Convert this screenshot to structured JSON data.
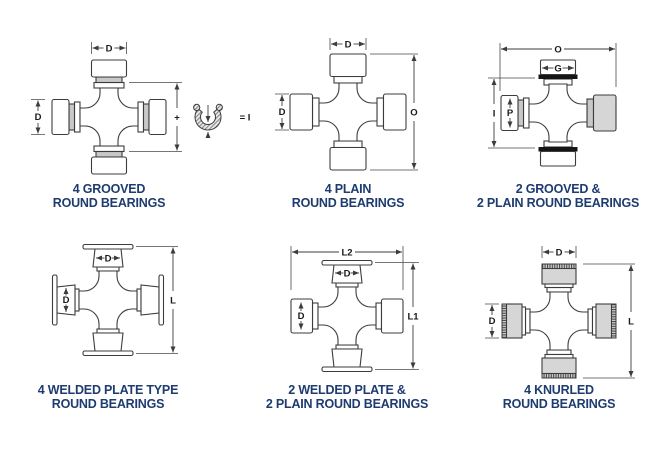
{
  "page": {
    "background_color": "#ffffff",
    "caption_color": "#1e3c70",
    "line_color": "#3c3c3c"
  },
  "diagrams": [
    {
      "id": "four-grooved-round-bearings",
      "caption_line1": "4 GROOVED",
      "caption_line2": "ROUND BEARINGS",
      "dim_top": "D",
      "dim_left": "D",
      "plus_symbol": "+",
      "snap_ring_equation": "= I",
      "snap_ring_icon": "snap-ring"
    },
    {
      "id": "four-plain-round-bearings",
      "caption_line1": "4 PLAIN",
      "caption_line2": "ROUND BEARINGS",
      "dim_top": "D",
      "dim_left": "D",
      "dim_right": "O"
    },
    {
      "id": "two-grooved-two-plain-round-bearings",
      "caption_line1": "2 GROOVED &",
      "caption_line2": "2 PLAIN ROUND BEARINGS",
      "dim_top_overall": "O",
      "dim_cap": "G",
      "dim_left": "I",
      "dim_inner": "P"
    },
    {
      "id": "four-welded-plate-round-bearings",
      "caption_line1": "4 WELDED PLATE TYPE",
      "caption_line2": "ROUND BEARINGS",
      "dim_top": "D",
      "dim_left": "D",
      "dim_right": "L"
    },
    {
      "id": "two-welded-plate-two-plain-round-bearings",
      "caption_line1": "2 WELDED PLATE &",
      "caption_line2": "2 PLAIN ROUND BEARINGS",
      "dim_top_overall": "L2",
      "dim_top": "D",
      "dim_left": "D",
      "dim_right": "L1"
    },
    {
      "id": "four-knurled-round-bearings",
      "caption_line1": "4 KNURLED",
      "caption_line2": "ROUND BEARINGS",
      "dim_top": "D",
      "dim_left": "D",
      "dim_right": "L"
    }
  ]
}
